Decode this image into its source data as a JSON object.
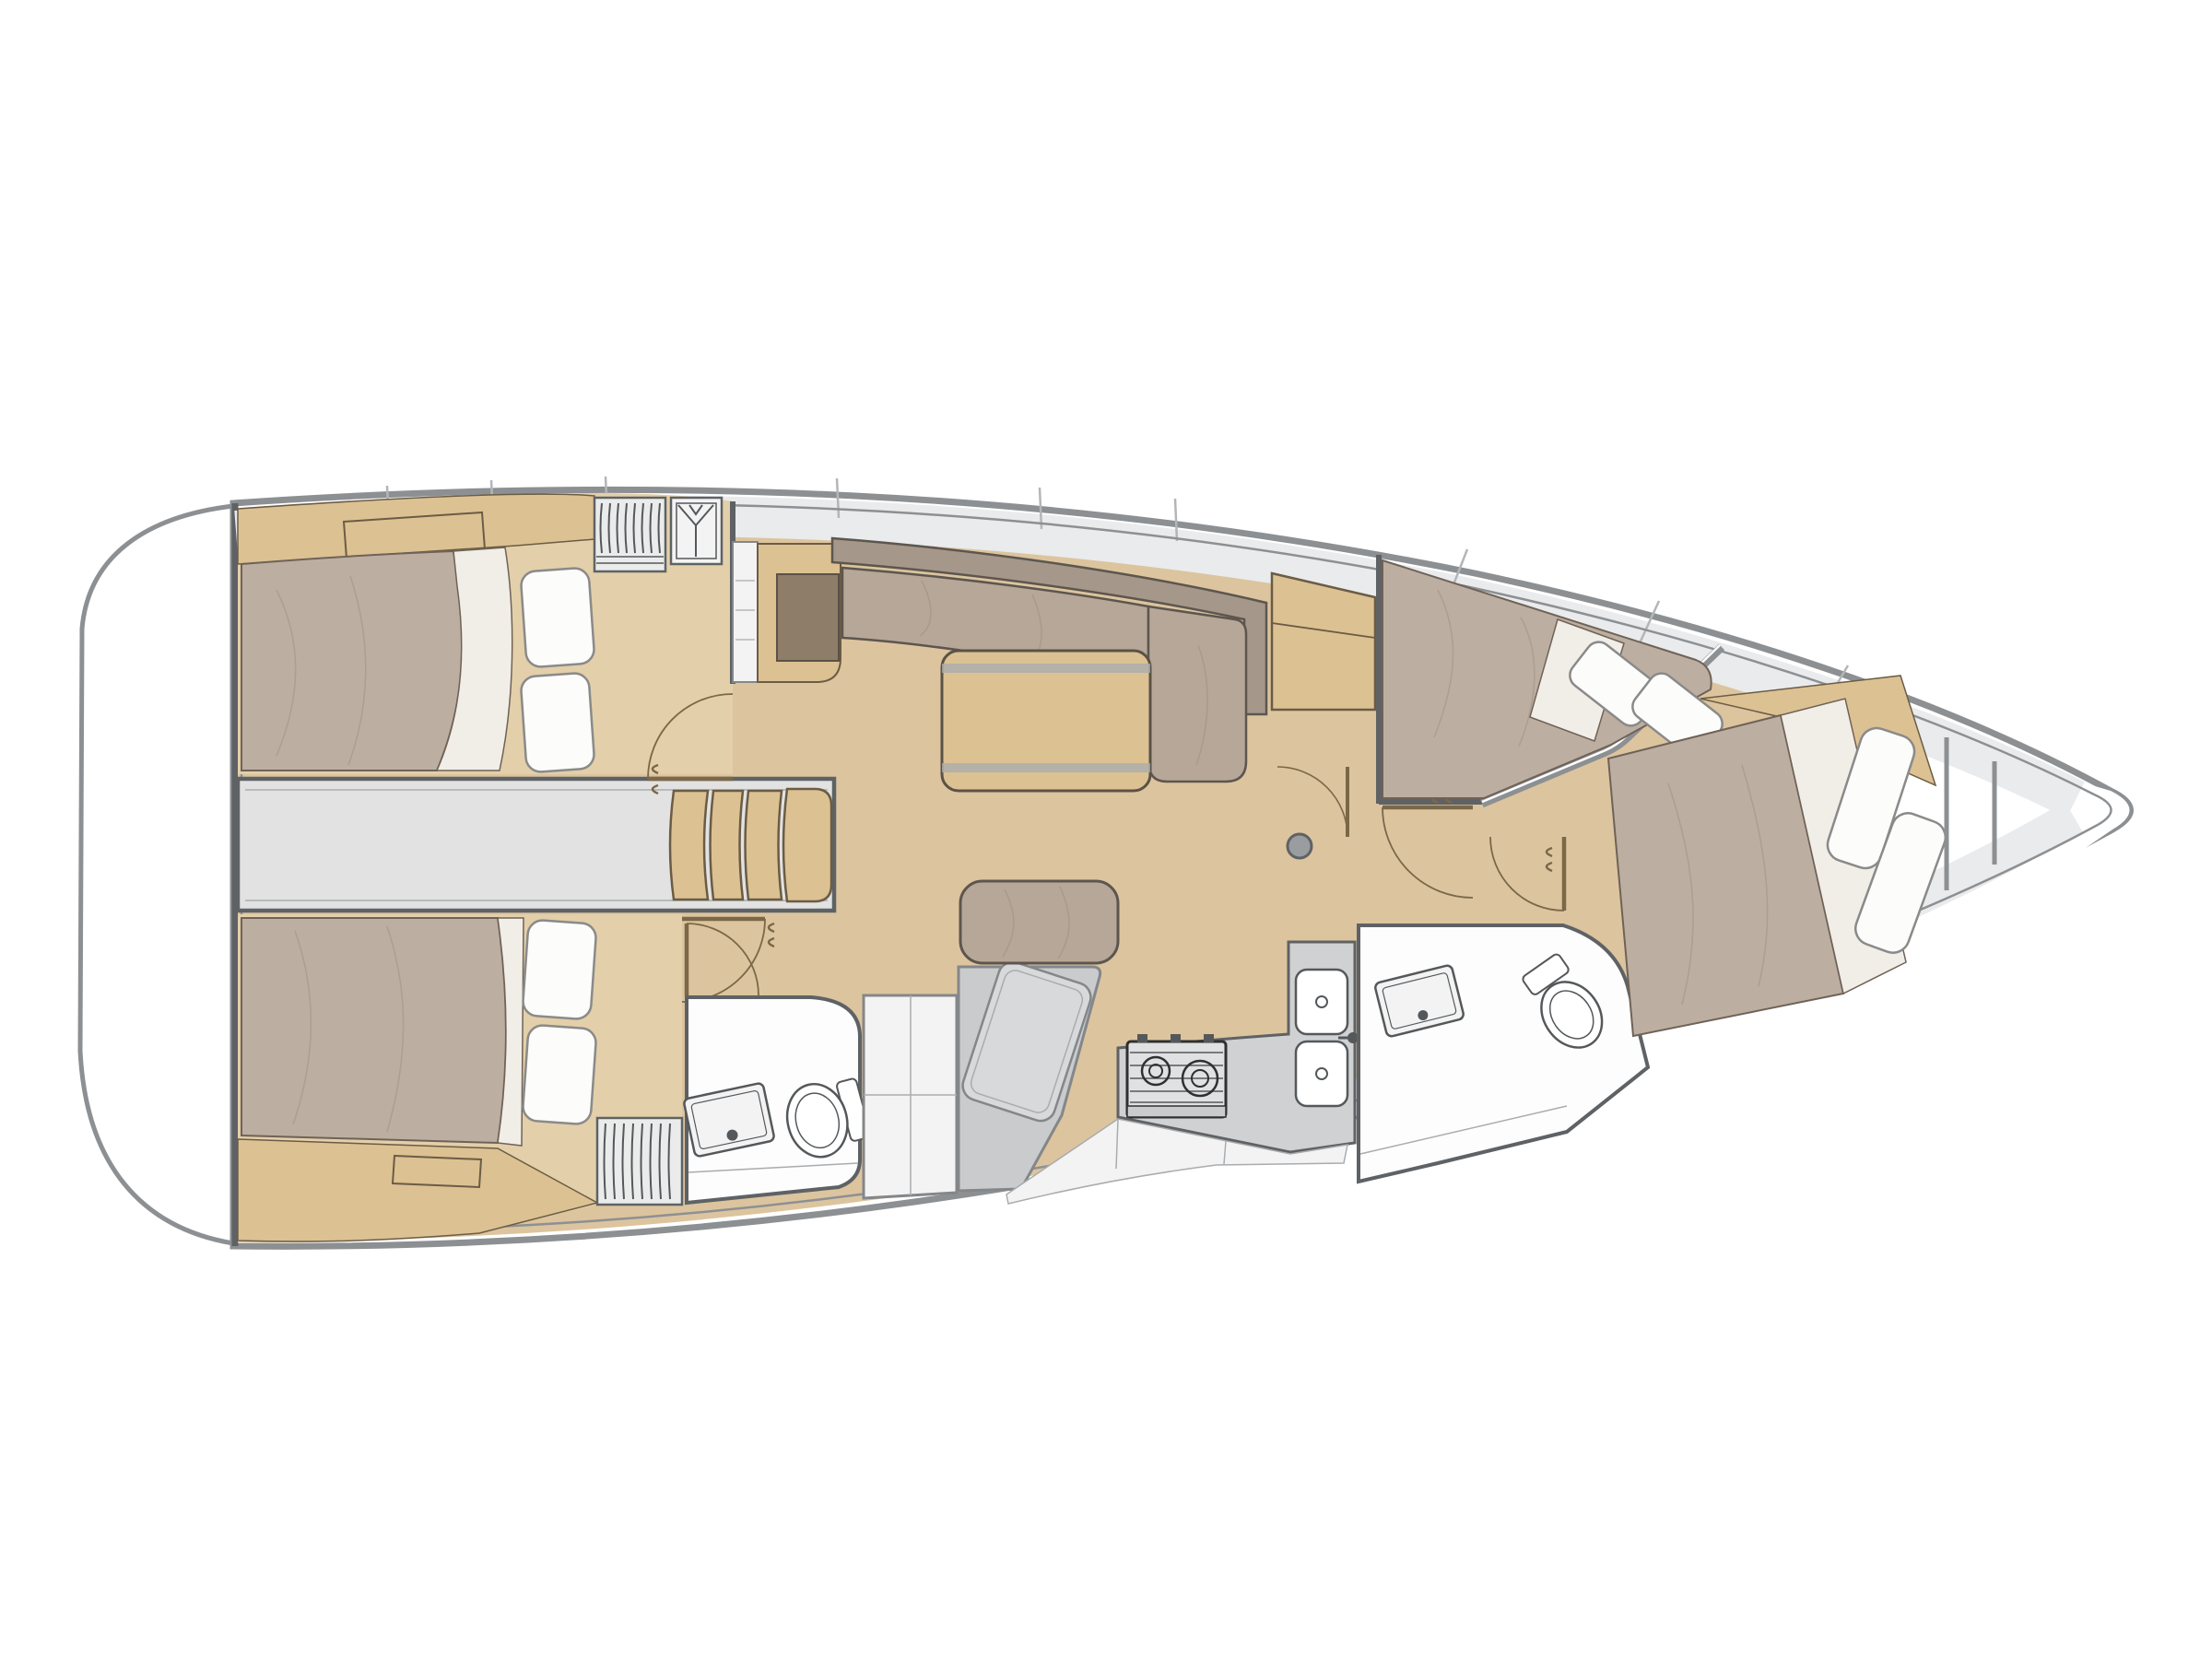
{
  "diagram": {
    "kind": "sailing-yacht-interior-floor-plan",
    "orientation": "bow-right-stern-left",
    "visible_text": [],
    "rooms": [
      {
        "id": "transom-platform",
        "label": "stern swim platform"
      },
      {
        "id": "aft-cabin-starboard",
        "label": "aft double cabin (top)"
      },
      {
        "id": "aft-cabin-port",
        "label": "aft double cabin (bottom)"
      },
      {
        "id": "cockpit-walkway",
        "label": "cockpit / engine walkway"
      },
      {
        "id": "companionway",
        "label": "companionway steps"
      },
      {
        "id": "saloon",
        "label": "saloon with L-settee and table"
      },
      {
        "id": "nav-station",
        "label": "chart table with bench seat"
      },
      {
        "id": "galley",
        "label": "galley with stove and double sink"
      },
      {
        "id": "aft-head",
        "label": "aft head with toilet and basin"
      },
      {
        "id": "forward-head",
        "label": "forward head with toilet and basin"
      },
      {
        "id": "forward-cabin",
        "label": "forward cabin with island berth and side berth"
      },
      {
        "id": "anchor-locker",
        "label": "bow anchor locker"
      }
    ],
    "furniture": [
      "double-bed",
      "pillows",
      "hanging-locker",
      "wardrobe",
      "steps",
      "settee",
      "saloon-table",
      "chart-desk",
      "bench-cushion",
      "stove",
      "double-sink",
      "toilet",
      "washbasin",
      "mast-post",
      "cabinet"
    ]
  },
  "palette": {
    "bg": "#ffffff",
    "hullStroke": "#8d9093",
    "hullFill": "#ffffff",
    "deckBand": "#e9ebed",
    "seam": "#b3b6b9",
    "wallDark": "#5f6265",
    "wallMid": "#84878a",
    "woodFloor": "#dcc49e",
    "woodFloorLight": "#e3cfa9",
    "woodFurniture": "#dcc192",
    "woodEdge": "#6b5c45",
    "duvet": "#bcaea1",
    "duvetLine": "#6f6257",
    "wrinkle": "#9c8f83",
    "sheetWhite": "#f1eee7",
    "pillow": "#fcfcfb",
    "pillowStroke": "#8a8a8a",
    "cushion": "#b6a798",
    "cushionBack": "#a5978a",
    "cushionStroke": "#5d564e",
    "grayCorridor": "#e2e2e2",
    "grayLine": "#a9acae",
    "grayNav": "#c9cbcc",
    "grayNavTop": "#d7d9da",
    "grayCounter": "#cfd1d2",
    "brownDesk": "#8d7d69",
    "deskEdge": "#5b5246",
    "white": "#ffffff",
    "offWhite": "#f3f3f3",
    "fixtureFill": "#fdfdfd",
    "fixtureStroke": "#55585a",
    "stoveFrame": "#303030",
    "stoveFill": "#e0e1e2",
    "metal": "#9a9da0",
    "doorBrown": "#7a6848",
    "lockerFill": "#eaecec"
  }
}
